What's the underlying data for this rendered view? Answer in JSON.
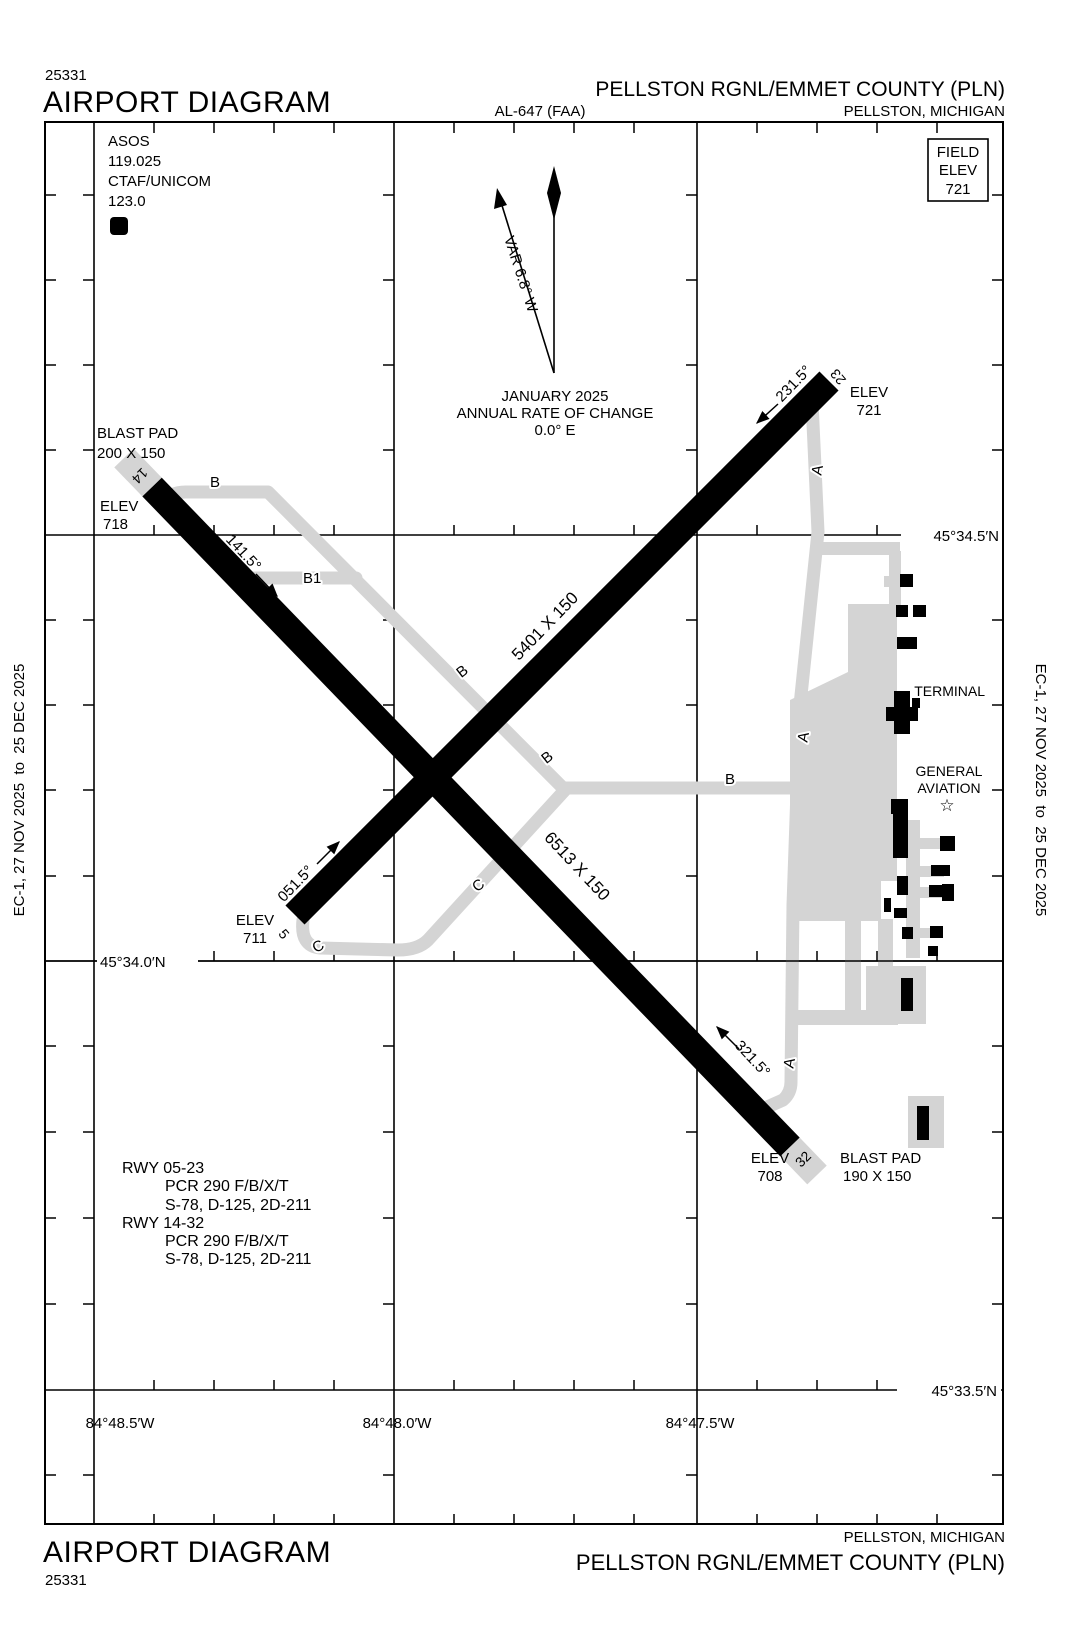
{
  "header": {
    "chart_code": "25331",
    "title": "AIRPORT DIAGRAM",
    "procedure": "AL-647 (FAA)",
    "airport": "PELLSTON RGNL/EMMET COUNTY (PLN)",
    "city": "PELLSTON, MICHIGAN"
  },
  "footer": {
    "chart_code": "25331",
    "title": "AIRPORT DIAGRAM",
    "airport": "PELLSTON RGNL/EMMET COUNTY (PLN)",
    "city": "PELLSTON, MICHIGAN"
  },
  "margin_note": "EC-1, 27 NOV 2025  to  25 DEC 2025",
  "field_elev": {
    "l1": "FIELD",
    "l2": "ELEV",
    "value": "721"
  },
  "comms": {
    "asos_label": "ASOS",
    "asos_freq": "119.025",
    "ctaf_label": "CTAF/UNICOM",
    "ctaf_freq": "123.0",
    "d_symbol": "D"
  },
  "north": {
    "variation": "VAR 6.8° W",
    "date": "JANUARY 2025",
    "roc_label": "ANNUAL RATE OF CHANGE",
    "roc_value": "0.0° E"
  },
  "runway_0523": {
    "dim": "5401 X 150",
    "end5": {
      "num": "5",
      "hdg": "051.5°",
      "elev_label": "ELEV",
      "elev": "711"
    },
    "end23": {
      "num": "23",
      "hdg": "231.5°",
      "elev_label": "ELEV",
      "elev": "721"
    }
  },
  "runway_1432": {
    "dim": "6513 X 150",
    "end14": {
      "num": "14",
      "hdg": "141.5°",
      "elev_label": "ELEV",
      "elev": "718",
      "blast_l1": "BLAST PAD",
      "blast_l2": "200 X 150"
    },
    "end32": {
      "num": "32",
      "hdg": "321.5°",
      "elev_label": "ELEV",
      "elev": "708",
      "blast_l1": "BLAST PAD",
      "blast_l2": "190 X 150"
    }
  },
  "taxiways": {
    "a": "A",
    "b": "B",
    "b1": "B1",
    "c": "C"
  },
  "buildings": {
    "terminal": "TERMINAL",
    "ga1": "GENERAL",
    "ga2": "AVIATION",
    "star_icon": "☆"
  },
  "grid": {
    "lat": [
      "45°34.5′N",
      "45°34.0′N",
      "45°33.5′N"
    ],
    "lon": [
      "84°48.5′W",
      "84°48.0′W",
      "84°47.5′W"
    ]
  },
  "runway_data": {
    "r1_title": "RWY 05-23",
    "r1_pcr": "PCR 290 F/B/X/T",
    "r1_codes": "S-78, D-125, 2D-211",
    "r2_title": "RWY 14-32",
    "r2_pcr": "PCR 290 F/B/X/T",
    "r2_codes": "S-78, D-125, 2D-211"
  },
  "colors": {
    "pavement_gray": "#d4d4d4",
    "ink": "#000000"
  }
}
